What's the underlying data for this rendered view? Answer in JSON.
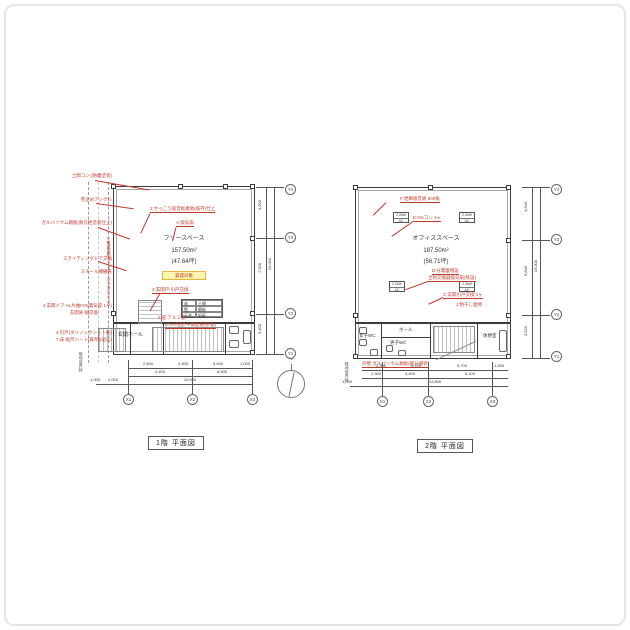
{
  "page": {
    "frame_color": "#e6e6e6",
    "ink": "#3c3c3c",
    "red": "#c03a2b"
  },
  "compass": {
    "label": "N"
  },
  "plan1": {
    "title": "1階 平面図",
    "space": {
      "name": "フリースペース",
      "area": "157.50m²",
      "tsubo": "(47.64坪)",
      "tag": "賃貸対象"
    },
    "notes_left": [
      "土間コン:(防塵塗装)",
      "雪止めアングル",
      "ガルバリウム鋼板(耐久性塗装仕上)",
      "スライディングドア交換",
      "スチール棚撤去",
      "4:玄関ドア:AL片袖FIX(電気錠 1ヶ)",
      "玄関扉 総交換",
      "4:引戸(ダイノックシート貼)",
      "7:床:長尺シート(既存)(貼込)"
    ],
    "notes_inner": {
      "ceiling": "2:せっこう吸音板素地(既存)仕上",
      "vent": "A:換気扇",
      "door": "3:玄関戸:引戸交換",
      "canopy": "5:庇:アルミ庇",
      "midroof": "E:5%勾配 中間屋根(折板)",
      "shutter": "1:軽量電動シャッター W:4950 H:2700"
    },
    "entrance": "玄関ホール",
    "finish_table": [
      [
        "床",
        "土間"
      ],
      [
        "壁",
        "鋼板"
      ],
      [
        "天井",
        "折板"
      ]
    ],
    "dims": {
      "row1": [
        "2,600",
        "4,400",
        "5,000",
        "1,000"
      ],
      "row2": [
        "4,400",
        "6,500"
      ],
      "total": "10,900",
      "left_small": [
        "1,000",
        "2,000"
      ],
      "right": [
        "4,600",
        "7,000",
        "3,400"
      ],
      "right_total": "15,000"
    },
    "grid_x": [
      "X1",
      "X2",
      "X3"
    ],
    "grid_y": [
      "Y4",
      "Y3",
      "Y2",
      "Y1"
    ],
    "boundary": "隣地境界線"
  },
  "plan2": {
    "title": "2階 平面図",
    "space": {
      "name": "オフィススペース",
      "area": "187.50m²",
      "tsubo": "(56.71坪)"
    },
    "notes": {
      "ceiling": "F:岩綿吸音板 600角",
      "oa": "E:OAコン 4ヶ",
      "panel": "B:分電盤増設",
      "vent": "全熱交換器換気扇(移設)",
      "door": "C:玄関引戸交換 1ヶ",
      "hang": "J:物干し金物",
      "wall": "外壁:ガルバリウム鋼板(部分補修)"
    },
    "ac_unit": {
      "power": "2.2kW",
      "type": "AC"
    },
    "rooms": {
      "wc_w": "女子WC",
      "wc_m": "男子WC",
      "hall": "ホール",
      "rest": "休憩室"
    },
    "dims": {
      "row1": [
        "2,300",
        "4,700",
        "5,700",
        "1,200"
      ],
      "row2": [
        "2,300",
        "4,400",
        "6,100"
      ],
      "total": "12,800",
      "left_small": "1,000",
      "right": [
        "4,640",
        "6,840",
        "3,520"
      ],
      "right_total": "15,000"
    },
    "grid_x": [
      "X1",
      "X2",
      "X3"
    ],
    "grid_y": [
      "Y4",
      "Y3",
      "Y2",
      "Y1"
    ],
    "boundary": "隣地境界線"
  }
}
